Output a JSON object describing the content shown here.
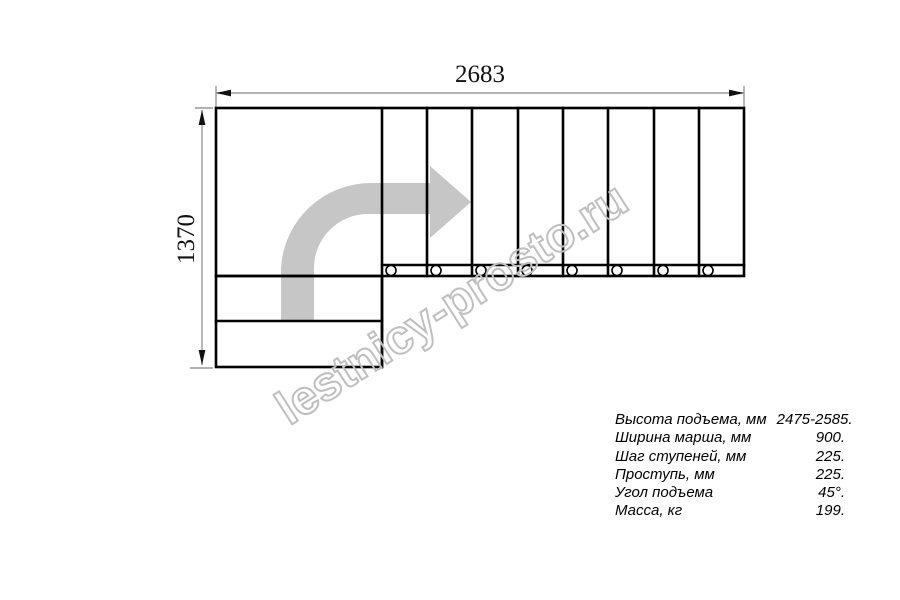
{
  "dimensions": {
    "top": "2683",
    "left": "1370"
  },
  "drawing": {
    "type": "L-shaped staircase plan view",
    "upper_run_tread_count": 8,
    "lower_run_step_count": 2,
    "fastener_circle_count": 8,
    "line_color": "#000000",
    "dimension_line_color": "#999999",
    "dimension_text_color": "#111111",
    "direction_arrow_color": "#c6c6c6"
  },
  "watermark": {
    "text": "lestnicy-prosto.ru",
    "stroke_color": "#bfbfbf"
  },
  "specs": {
    "rows": [
      {
        "label": "Высота подъема, мм",
        "value": "2475-2585."
      },
      {
        "label": "Ширина марша, мм",
        "value": "900."
      },
      {
        "label": "Шаг ступеней, мм",
        "value": "225."
      },
      {
        "label": "Проступь, мм",
        "value": "225."
      },
      {
        "label": "Угол подъема",
        "value": "45°."
      },
      {
        "label": "Масса, кг",
        "value": "199."
      }
    ]
  }
}
